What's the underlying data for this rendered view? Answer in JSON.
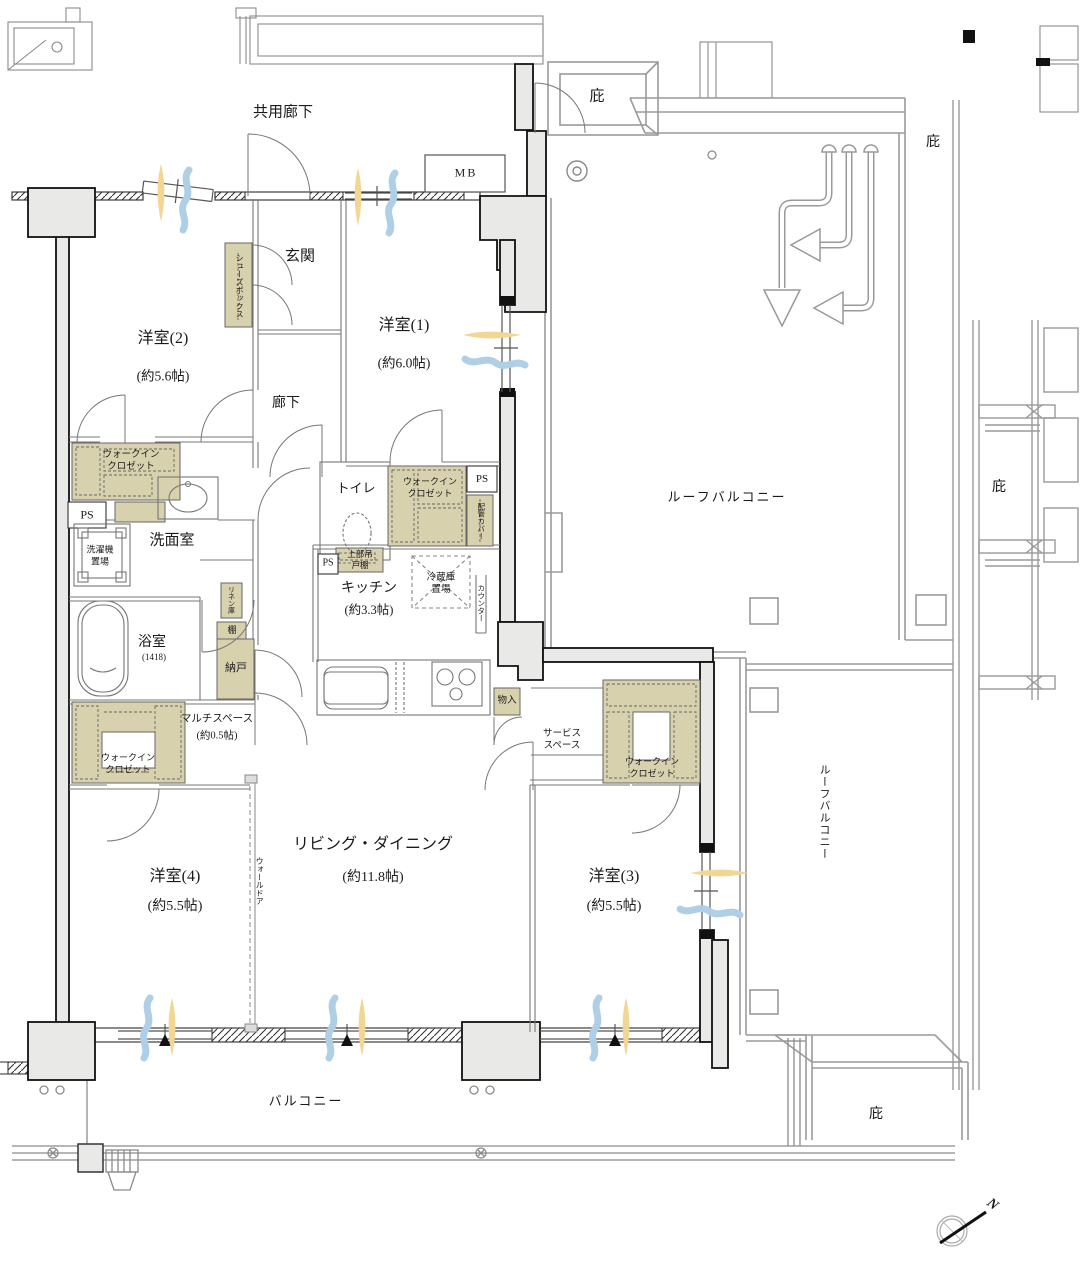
{
  "plan": {
    "type": "apartment-floor-plan",
    "labels": {
      "common_corridor": "共用廊下",
      "eaves": "庇",
      "meter_box": "MB",
      "entrance": "玄関",
      "shoe_box": "シューズボックス",
      "hallway": "廊下",
      "walk_in_closet": "ウォークインクロゼット",
      "pipe_space": "PS",
      "washroom": "洗面室",
      "washer_space": "洗濯機置場",
      "toilet": "トイレ",
      "pipe_cover": "配管カバー",
      "upper_cabinet": "上部吊戸棚",
      "fridge_space": "冷蔵庫置場",
      "counter": "カウンター",
      "linen": "リネン庫",
      "shelf": "棚",
      "storeroom": "納戸",
      "bathroom": "浴室",
      "bathroom_size": "(1418)",
      "multi_space": "マルチスペース",
      "multi_space_size": "(約0.5帖)",
      "wall_door": "ウォールドア",
      "closet_small": "物入",
      "service_space": "サービススペース",
      "roof_balcony": "ルーフバルコニー",
      "balcony": "バルコニー",
      "north": "N"
    },
    "rooms": {
      "western1": {
        "name": "洋室(1)",
        "size": "(約6.0帖)"
      },
      "western2": {
        "name": "洋室(2)",
        "size": "(約5.6帖)"
      },
      "western3": {
        "name": "洋室(3)",
        "size": "(約5.5帖)"
      },
      "western4": {
        "name": "洋室(4)",
        "size": "(約5.5帖)"
      },
      "living_dining": {
        "name": "リビング・ダイニング",
        "size": "(約11.8帖)"
      },
      "kitchen": {
        "name": "キッチン",
        "size": "(約3.3帖)"
      }
    },
    "colors": {
      "closet_fill": "#d8d1ae",
      "wall_fill": "#e9e9e7",
      "airflow_blue": "#aecfe6",
      "sunlight_yellow": "#f2d794"
    }
  }
}
